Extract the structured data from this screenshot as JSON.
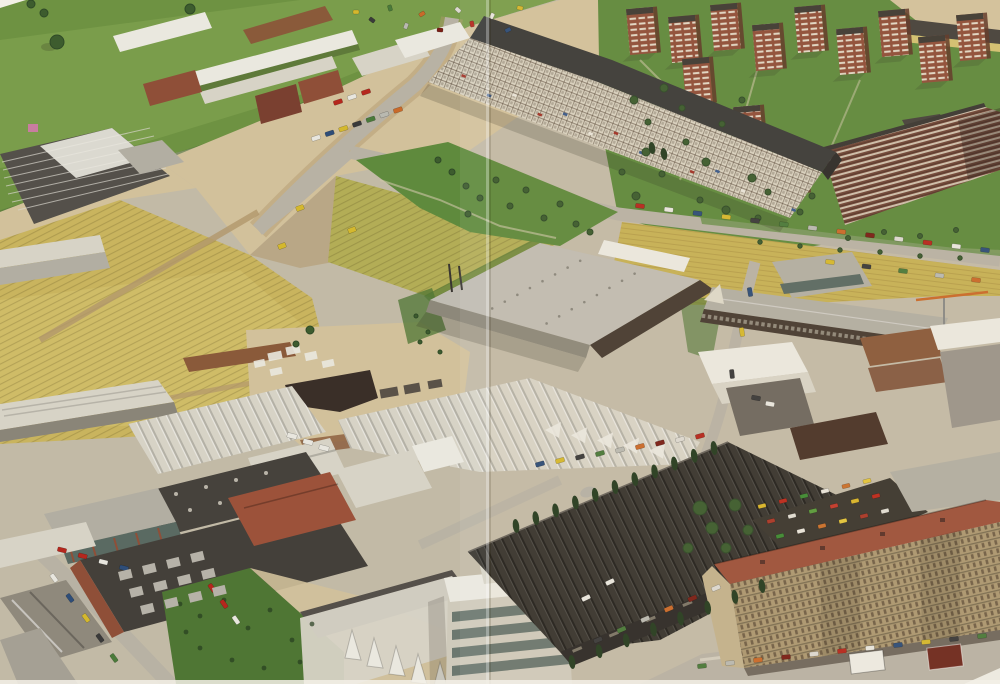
{
  "meta": {
    "type": "aerial-photograph-book-spread",
    "description": "Oblique aerial photograph of a 1970s urban periphery: green meadows, striped yellow farm fields and construction sites on the left; factories, a large grey flat-roofed warehouse and sawtooth-roofed industrial plants lined with cypress trees below; clusters of red-brick high-rise apartment towers, a long bent white residential slab and tree-lined streets with parked cars on the right; a long beige apartment block with a red tile roof in the lower right corner. A vertical fold crease runs down the centre of the photograph.",
    "visible_text": "none"
  },
  "palette": {
    "pageWhite": "#f3f0e7",
    "concrete": "#c2baa6",
    "dirtLight": "#d2c19b",
    "dirtDark": "#b2976c",
    "grass": "#6e9242",
    "grassLight": "#86a854",
    "grassDark": "#54763a",
    "lawn": "#5f8a3d",
    "wildGreen": "#4f7634",
    "fieldYellow": "#c9b45e",
    "fieldYellowLight": "#d7c574",
    "fieldGY": "#b3ad56",
    "dryBand": "#c6b055",
    "roofLight": "#d7d3c6",
    "roofWhite": "#eae8df",
    "roofGray": "#b2aea2",
    "roofDark": "#46423c",
    "roofCharcoal": "#38352f",
    "slabRoof": "#3b3b38",
    "slabFace": "#d9d2c0",
    "brick": "#8f4f38",
    "brickDark": "#7a4030",
    "rust": "#8a5a3a",
    "tile": "#9c523a",
    "beige": "#ab9770",
    "darkFace": "#473c31",
    "glass": "#5a6a62",
    "road": "#b8b2a4",
    "asphalt": "#6e685e",
    "treeDark": "#2f4a27",
    "treeMid": "#3d5c2e",
    "cypress": "#263d20",
    "white": "#eceae2",
    "pink": "#c97da0",
    "crane": "#c96a2a",
    "shadow": "rgba(40,35,25,0.38)",
    "foldLight": "rgba(255,255,255,0.30)",
    "foldDark": "rgba(80,60,30,0.18)"
  },
  "cars": {
    "colors": [
      "#b5271d",
      "#e8e6de",
      "#2e4d78",
      "#d4b82e",
      "#3a3a3a",
      "#4a7a3a",
      "#b9b9b0",
      "#c96a2a",
      "#7a1f16",
      "#dcd9d0"
    ],
    "junk_colors": [
      "#d8b52a",
      "#bb2a1c",
      "#3f8a33",
      "#e8e4da",
      "#c9702c",
      "#e3c43b",
      "#a83828",
      "#e0ddd2",
      "#5a9a3c",
      "#c0392b"
    ]
  }
}
